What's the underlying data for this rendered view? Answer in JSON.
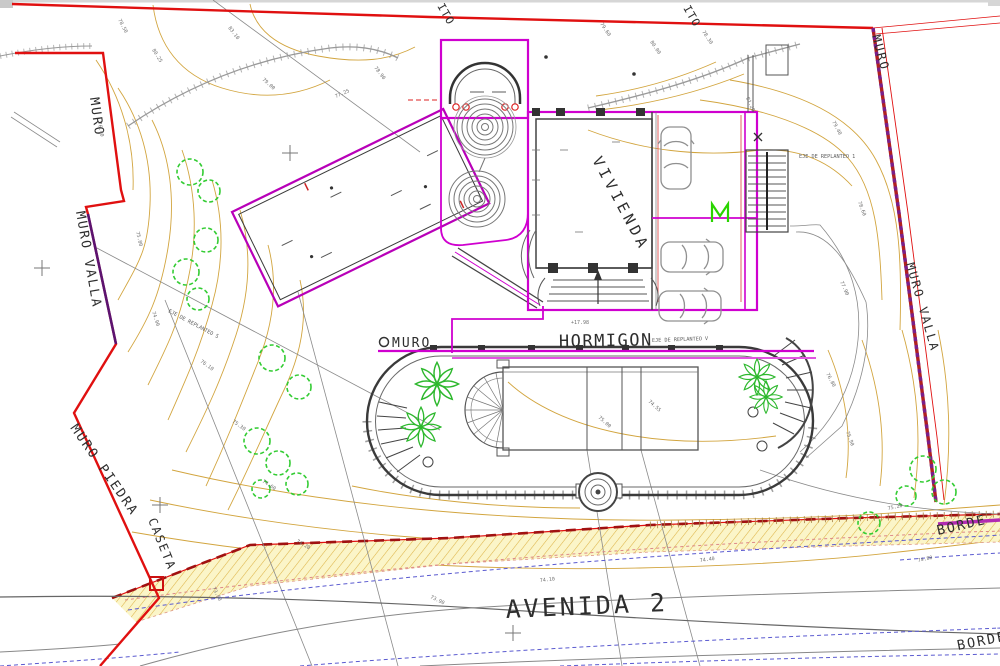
{
  "drawing": {
    "type": "architectural-site-plan",
    "labels": {
      "muro_top_left": "MURO",
      "muro_valla_left": "MURO VALLA",
      "muro_piedra": "MURO PIEDRA",
      "caseta": "CASETA",
      "muro_driveway": "MURO",
      "hormigon": "HORMIGON",
      "hormigon_note": "EJE DE REPLANTEO V",
      "vivienda": "VIVIENDA",
      "muro_top_right": "MURO",
      "muro_valla_right": "MURO VALLA",
      "avenida": "AVENIDA 2",
      "borde_upper": "BORDE",
      "borde_lower": "BORDE",
      "hito_left": "ITO",
      "hito_right": "ITO",
      "eje_replanteo_1": "EJE DE REPLANTEO 1",
      "eje_replanteo_5": "EJE DE REPLANTEO 5"
    },
    "colors": {
      "boundary_red": "#e01010",
      "wall_magenta": "#cf00cf",
      "wall_purple": "#7a1f8a",
      "contour_tan": "#d2a53f",
      "vegetation_green": "#33cc33",
      "gate_green": "#2ad400",
      "road_blue": "#5a5ad0",
      "band_fill": "#fbf5c8",
      "band_hatch": "#ddb347",
      "dashed_pink": "#dd8888",
      "ink_dark": "#333333",
      "line_gray": "#8a8a8a"
    },
    "elevation_marks": [
      {
        "t": "78.50",
        "x": 118,
        "y": 20,
        "r": 62
      },
      {
        "t": "80.25",
        "x": 152,
        "y": 50,
        "r": 58
      },
      {
        "t": "83.10",
        "x": 228,
        "y": 28,
        "r": 52
      },
      {
        "t": "79.00",
        "x": 262,
        "y": 80,
        "r": 42
      },
      {
        "t": "76.40",
        "x": 98,
        "y": 122,
        "r": 80
      },
      {
        "t": "75.80",
        "x": 136,
        "y": 232,
        "r": 76
      },
      {
        "t": "74.90",
        "x": 152,
        "y": 312,
        "r": 72
      },
      {
        "t": "76.10",
        "x": 200,
        "y": 362,
        "r": 36
      },
      {
        "t": "75.30",
        "x": 232,
        "y": 422,
        "r": 36
      },
      {
        "t": "74.60",
        "x": 262,
        "y": 482,
        "r": 34
      },
      {
        "t": "74.20",
        "x": 296,
        "y": 542,
        "r": 30
      },
      {
        "t": "73.80",
        "x": 212,
        "y": 588,
        "r": 62
      },
      {
        "t": "77.25",
        "x": 336,
        "y": 98,
        "r": -24
      },
      {
        "t": "78.90",
        "x": 374,
        "y": 68,
        "r": 52
      },
      {
        "t": "79.60",
        "x": 600,
        "y": 24,
        "r": 56
      },
      {
        "t": "80.00",
        "x": 650,
        "y": 42,
        "r": 56
      },
      {
        "t": "78.30",
        "x": 702,
        "y": 32,
        "r": 56
      },
      {
        "t": "81.20",
        "x": 746,
        "y": 98,
        "r": 66
      },
      {
        "t": "79.40",
        "x": 832,
        "y": 122,
        "r": 62
      },
      {
        "t": "78.60",
        "x": 858,
        "y": 202,
        "r": 70
      },
      {
        "t": "77.90",
        "x": 840,
        "y": 282,
        "r": 66
      },
      {
        "t": "76.80",
        "x": 826,
        "y": 374,
        "r": 62
      },
      {
        "t": "75.90",
        "x": 846,
        "y": 432,
        "r": 70
      },
      {
        "t": "75.20",
        "x": 888,
        "y": 510,
        "r": -12
      },
      {
        "t": "74.80",
        "x": 918,
        "y": 562,
        "r": -12
      },
      {
        "t": "74.40",
        "x": 700,
        "y": 562,
        "r": -8
      },
      {
        "t": "74.10",
        "x": 540,
        "y": 582,
        "r": -6
      },
      {
        "t": "73.90",
        "x": 430,
        "y": 598,
        "r": 26
      },
      {
        "t": "+17.98",
        "x": 571,
        "y": 324,
        "r": 0
      },
      {
        "t": "75.00",
        "x": 598,
        "y": 418,
        "r": 42
      },
      {
        "t": "74.55",
        "x": 648,
        "y": 402,
        "r": 42
      }
    ]
  }
}
